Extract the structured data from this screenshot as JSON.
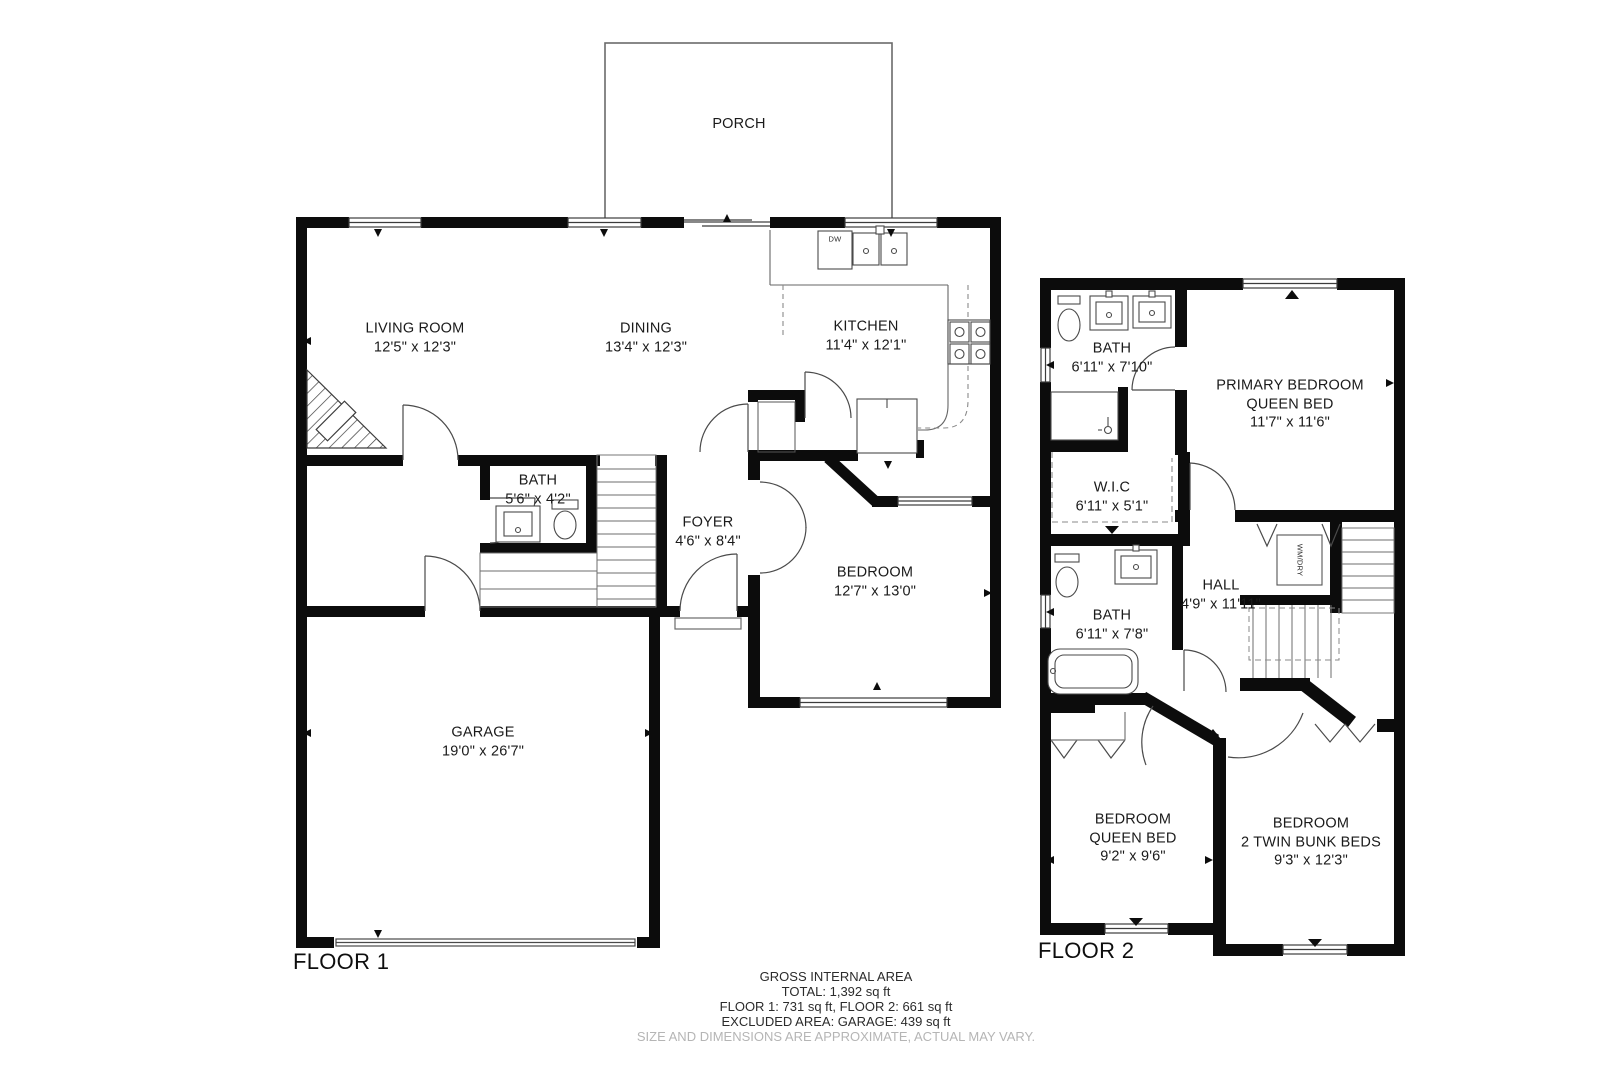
{
  "floor1": {
    "label": "FLOOR 1",
    "rooms": {
      "porch": {
        "name": "PORCH",
        "dims": ""
      },
      "living": {
        "name": "LIVING ROOM",
        "dims": "12'5\" x 12'3\""
      },
      "dining": {
        "name": "DINING",
        "dims": "13'4\" x 12'3\""
      },
      "kitchen": {
        "name": "KITCHEN",
        "dims": "11'4\" x 12'1\""
      },
      "bath": {
        "name": "BATH",
        "dims": "5'6\" x 4'2\""
      },
      "foyer": {
        "name": "FOYER",
        "dims": "4'6\" x 8'4\""
      },
      "bedroom": {
        "name": "BEDROOM",
        "dims": "12'7\" x 13'0\""
      },
      "garage": {
        "name": "GARAGE",
        "dims": "19'0\" x 26'7\""
      }
    },
    "fixtures": {
      "dishwasher": "DW"
    }
  },
  "floor2": {
    "label": "FLOOR 2",
    "rooms": {
      "bath_top": {
        "name": "BATH",
        "dims": "6'11\" x 7'10\""
      },
      "primary": {
        "name": "PRIMARY BEDROOM",
        "line2": "QUEEN BED",
        "dims": "11'7\" x 11'6\""
      },
      "wic": {
        "name": "W.I.C",
        "dims": "6'11\" x 5'1\""
      },
      "bath_mid": {
        "name": "BATH",
        "dims": "6'11\" x 7'8\""
      },
      "hall": {
        "name": "HALL",
        "dims": "4'9\" x 11'11\""
      },
      "bedroom_queen": {
        "name": "BEDROOM",
        "line2": "QUEEN BED",
        "dims": "9'2\" x 9'6\""
      },
      "bedroom_bunk": {
        "name": "BEDROOM",
        "line2": "2 TWIN BUNK BEDS",
        "dims": "9'3\" x 12'3\""
      }
    },
    "fixtures": {
      "washer_dryer": "WM/DRY"
    }
  },
  "footer": {
    "heading": "GROSS INTERNAL AREA",
    "total": "TOTAL: 1,392 sq ft",
    "floors": "FLOOR 1: 731 sq ft, FLOOR 2: 661 sq ft",
    "excluded": "EXCLUDED AREA: GARAGE: 439 sq ft",
    "disclaimer": "SIZE AND DIMENSIONS ARE APPROXIMATE, ACTUAL MAY VARY."
  }
}
